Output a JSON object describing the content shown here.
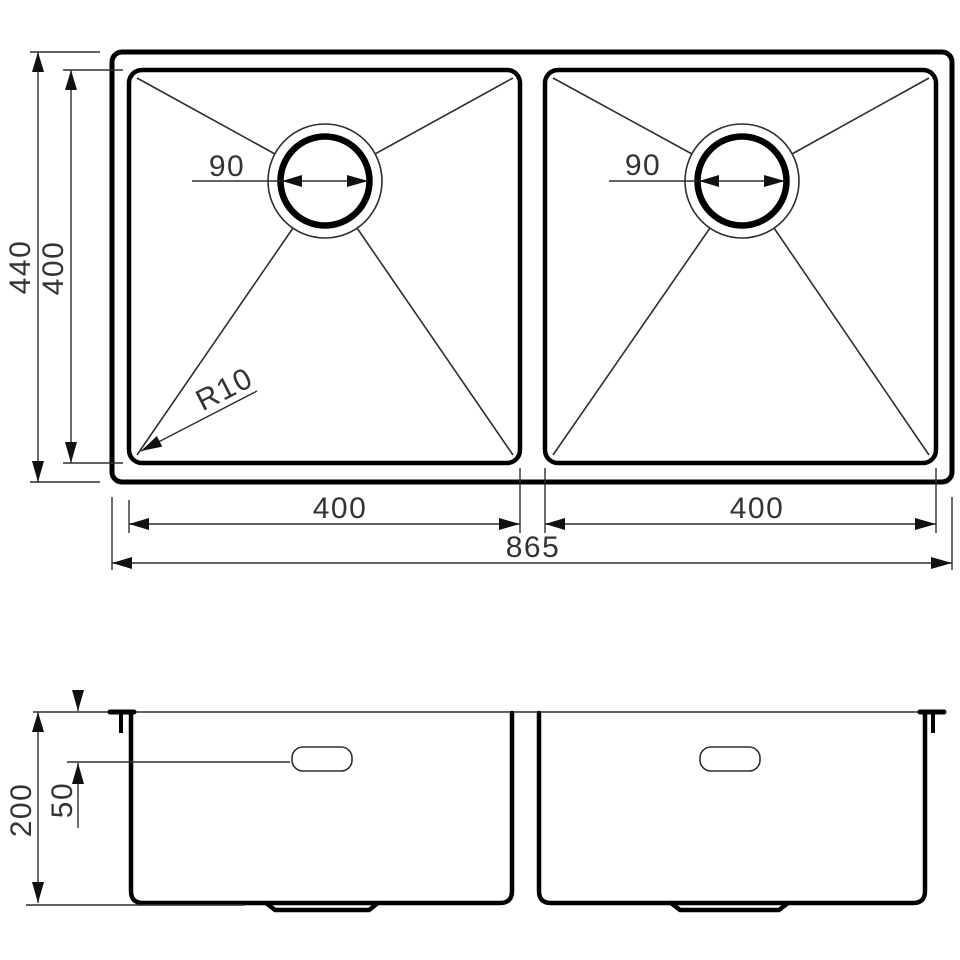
{
  "drawing": {
    "type": "technical-dimension-drawing",
    "subject": "double-bowl-sink",
    "colors": {
      "object_line": "#000000",
      "dimension_line": "#2e2e2e",
      "label_text": "#333333",
      "background": "#ffffff"
    },
    "top_view": {
      "overall_width": "865",
      "overall_depth": "440",
      "bowl_inner_depth": "400",
      "left_bowl_width": "400",
      "right_bowl_width": "400",
      "left_drain_diameter": "90",
      "right_drain_diameter": "90",
      "corner_radius": "R10"
    },
    "side_view": {
      "bowl_height": "200",
      "overflow_offset": "50"
    }
  }
}
